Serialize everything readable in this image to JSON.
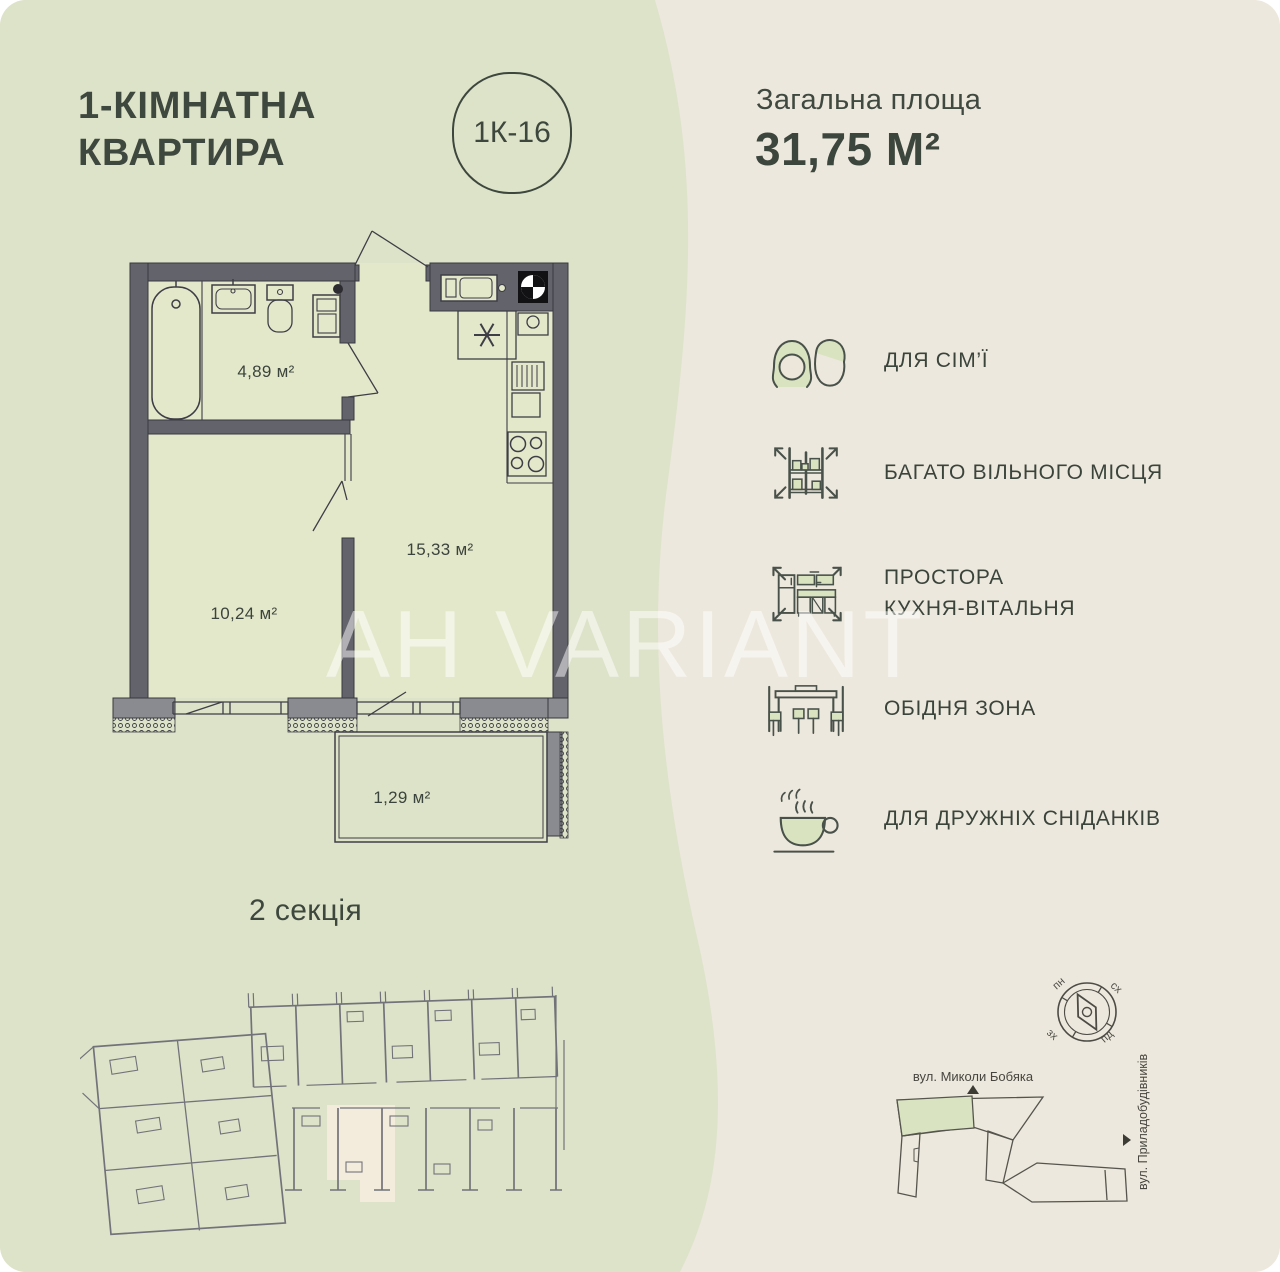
{
  "header": {
    "title_line1": "1-КІМНАТНА",
    "title_line2": "КВАРТИРА",
    "unit_badge": "1К-16",
    "area_label": "Загальна площа",
    "area_value": "31,75 М²"
  },
  "floor_plan": {
    "section_label": "2 секція",
    "watermark": "AH VARIANT",
    "rooms": [
      {
        "name": "bathroom",
        "area": "4,89 м²"
      },
      {
        "name": "kitchen-living-room",
        "area": "15,33 м²"
      },
      {
        "name": "bedroom",
        "area": "10,24 м²"
      },
      {
        "name": "balcony",
        "area": "1,29 м²"
      }
    ]
  },
  "features": [
    {
      "icon": "family-icon",
      "label": "ДЛЯ СІМ’Ї"
    },
    {
      "icon": "space-icon",
      "label": "БАГАТО ВІЛЬНОГО МІСЦЯ"
    },
    {
      "icon": "kitchen-icon",
      "label": "ПРОСТОРА КУХНЯ-ВІТАЛЬНЯ",
      "label_line1": "ПРОСТОРА",
      "label_line2": "КУХНЯ-ВІТАЛЬНЯ"
    },
    {
      "icon": "dining-icon",
      "label": "ОБІДНЯ ЗОНА"
    },
    {
      "icon": "breakfast-icon",
      "label": "ДЛЯ ДРУЖНІХ СНІДАНКІВ"
    }
  ],
  "site_map": {
    "street_top": "вул. Миколи Бобяка",
    "street_right": "вул. Приладобудівників",
    "compass": {
      "north": "пн",
      "east": "сх",
      "west": "зх",
      "south": "пд"
    }
  },
  "colors": {
    "bg_green": "#dde3c9",
    "bg_beige": "#ede8dd",
    "room_fill": "#e4e8cb",
    "wall": "#63636b",
    "icon_fill": "#dae3c0",
    "text": "#3f483e",
    "highlight_beige": "#f3ecdd",
    "highlight_green": "#d9e3c2"
  }
}
